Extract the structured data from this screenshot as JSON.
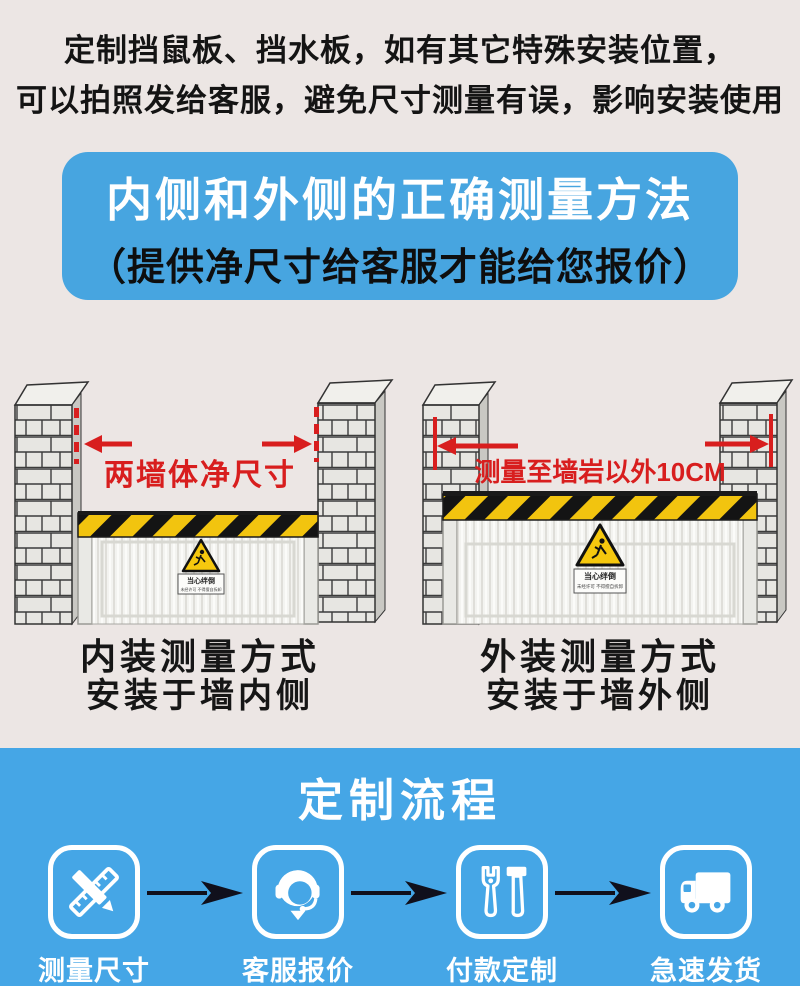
{
  "colors": {
    "background": "#ece6e4",
    "blue": "#47a5e0",
    "flow_blue": "#45a6e6",
    "red": "#d81e1e",
    "stripe_yellow": "#f2c40f",
    "stripe_black": "#141414"
  },
  "intro": {
    "line1": "定制挡鼠板、挡水板，如有其它特殊安装位置，",
    "line2": "可以拍照发给客服，避免尺寸测量有误，影响安装使用"
  },
  "banner": {
    "title": "内侧和外侧的正确测量方法",
    "subtitle": "（提供净尺寸给客服才能给您报价）"
  },
  "diagrams": [
    {
      "measure_label": "两墙体净尺寸",
      "caption_line1": "内装测量方式",
      "caption_line2": "安装于墙内侧",
      "sticker": {
        "line1": "当心绊倒",
        "line2": "未经许可 不得擅自拆卸"
      }
    },
    {
      "measure_label": "测量至墙岩以外10CM",
      "caption_line1": "外装测量方式",
      "caption_line2": "安装于墙外侧",
      "sticker": {
        "line1": "当心绊倒",
        "line2": "未经许可 不得擅自拆卸"
      }
    }
  ],
  "flow": {
    "title": "定制流程",
    "steps": [
      {
        "label": "测量尺寸",
        "icon": "ruler-pencil-icon"
      },
      {
        "label": "客服报价",
        "icon": "customer-service-icon"
      },
      {
        "label": "付款定制",
        "icon": "tools-icon"
      },
      {
        "label": "急速发货",
        "icon": "truck-icon"
      }
    ]
  }
}
